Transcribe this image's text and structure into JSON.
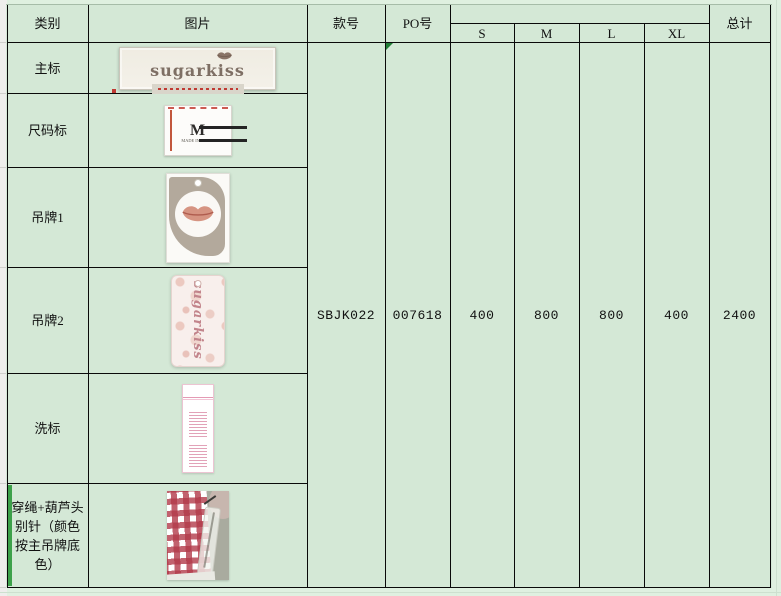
{
  "table": {
    "headers": {
      "category": "类别",
      "image": "图片",
      "style_no": "款号",
      "po_no": "PO号",
      "sizes": [
        "S",
        "M",
        "L",
        "XL"
      ],
      "total": "总计"
    },
    "rows": [
      {
        "label": "主标"
      },
      {
        "label": "尺码标"
      },
      {
        "label": "吊牌1"
      },
      {
        "label": "吊牌2"
      },
      {
        "label": "洗标"
      },
      {
        "label": "穿绳+葫芦头别针（颜色按主吊牌底色）"
      }
    ],
    "values": {
      "style_no": "SBJK022",
      "po_no": "007618",
      "s": "400",
      "m": "800",
      "l": "800",
      "xl": "400",
      "total": "2400"
    }
  },
  "artifacts": {
    "main_label": {
      "brand": "sugarkiss"
    },
    "size_label": {
      "size": "M",
      "caption": "MADE IN CHINA"
    },
    "hangtag2": {
      "brand": "sugarkiss"
    }
  },
  "colors": {
    "cell_green": "#d4e8d6",
    "grid_black": "#0a0a0a",
    "error_indicator_green": "#1f7d35",
    "accent_bar_green": "#3da14a",
    "gingham_red": "#b23a4a"
  }
}
